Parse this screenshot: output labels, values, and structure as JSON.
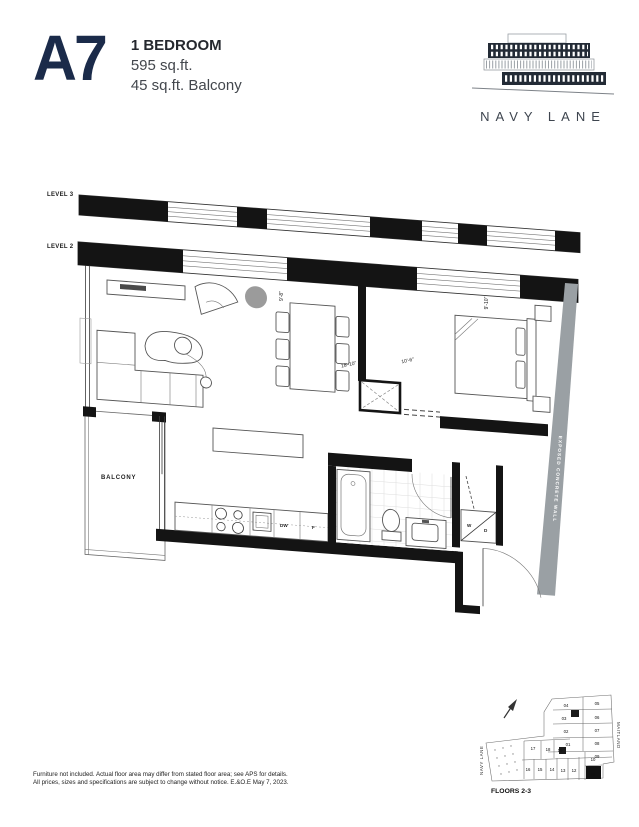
{
  "header": {
    "unit_code": "A7",
    "unit_type": "1 BEDROOM",
    "area": "595 sq.ft.",
    "balcony_area": "45 sq.ft. Balcony",
    "brand": "NAVY LANE"
  },
  "plan": {
    "level3_label": "LEVEL 3",
    "level2_label": "LEVEL 2",
    "balcony_label": "BALCONY",
    "wall_label": "EXPOSED CONCRETE WALL",
    "appliances": {
      "dishwasher": "DW",
      "fridge": "F",
      "washer": "W",
      "dryer": "D"
    },
    "dimensions": {
      "living_length": "18'-10\"",
      "living_width": "9'-8\"",
      "bedroom_length": "10'-6\"",
      "bedroom_width": "9'-10\""
    }
  },
  "keyplan": {
    "caption": "FLOORS 2-3",
    "street_left": "NAVY LANE",
    "street_right": "MAITLAND",
    "highlighted_unit": "11",
    "units": [
      "04",
      "05",
      "03",
      "06",
      "02",
      "07",
      "01",
      "08",
      "09",
      "17",
      "18",
      "19",
      "16",
      "15",
      "14",
      "13",
      "12",
      "10",
      "11"
    ]
  },
  "footer": {
    "line1": "Furniture not included. Actual floor area may differ from stated floor area; see APS for details.",
    "line2": "All prices, sizes and specifications are subject to change without notice. E.&O.E May 7, 2023."
  },
  "colors": {
    "accent": "#1b2b4a",
    "concrete": "#9aa0a4",
    "wall": "#141414"
  }
}
